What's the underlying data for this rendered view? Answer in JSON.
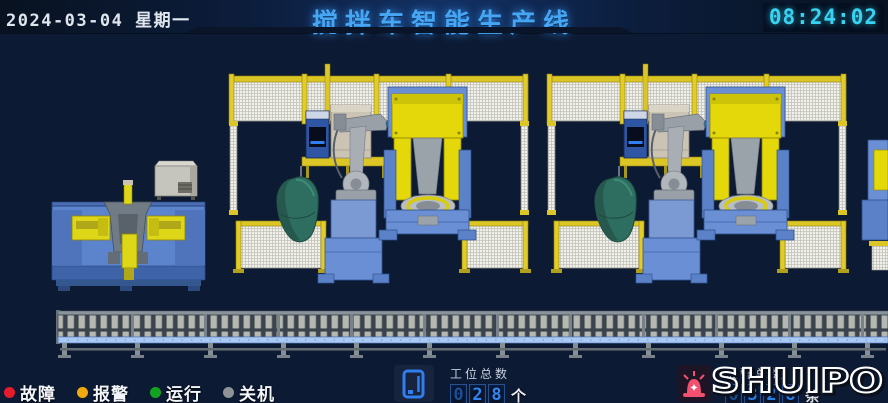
{
  "header": {
    "date": "2024-03-04 星期一",
    "title": "搅拌车智能生产线",
    "time": "08:24:02",
    "title_color": "#46a6f4",
    "time_color": "#38d2f2"
  },
  "status_bar": {
    "legend": [
      {
        "label": "故障",
        "color": "#e61b2c"
      },
      {
        "label": "报警",
        "color": "#f2a90e"
      },
      {
        "label": "运行",
        "color": "#12a21f"
      },
      {
        "label": "关机",
        "color": "#8f9398"
      }
    ],
    "station_counter": {
      "icon": "terminal-icon",
      "label": "工位总数",
      "digits": [
        "0",
        "2",
        "8"
      ],
      "unit": "个"
    },
    "alarm_counter": {
      "icon": "alarm-beacon-icon",
      "label": "报警总数",
      "digits": [
        "0",
        "3",
        "2",
        "8"
      ],
      "unit": "条"
    },
    "logo_text": "SHUIPO"
  },
  "scene": {
    "elements": [
      "frame-clamping-station",
      "control-cabinet",
      "welding-cell-1",
      "welding-cell-2",
      "partial-station-right",
      "roller-conveyor"
    ],
    "colors": {
      "background": "#0d1a33",
      "fence_yellow": "#dcc626",
      "fence_mesh": "#f1f1ec",
      "machine_blue": "#5b84cc",
      "pedestal_blue": "#7b99d2",
      "positioner_yellow": "#e4d80a",
      "robot_gray": "#a9aeb4",
      "cabinet_tan": "#cbc4b4",
      "cabinet_gray": "#c5c4bd",
      "cone_teal": "#2e6e60",
      "conveyor_rail_blue": "#a9c9f2"
    }
  }
}
